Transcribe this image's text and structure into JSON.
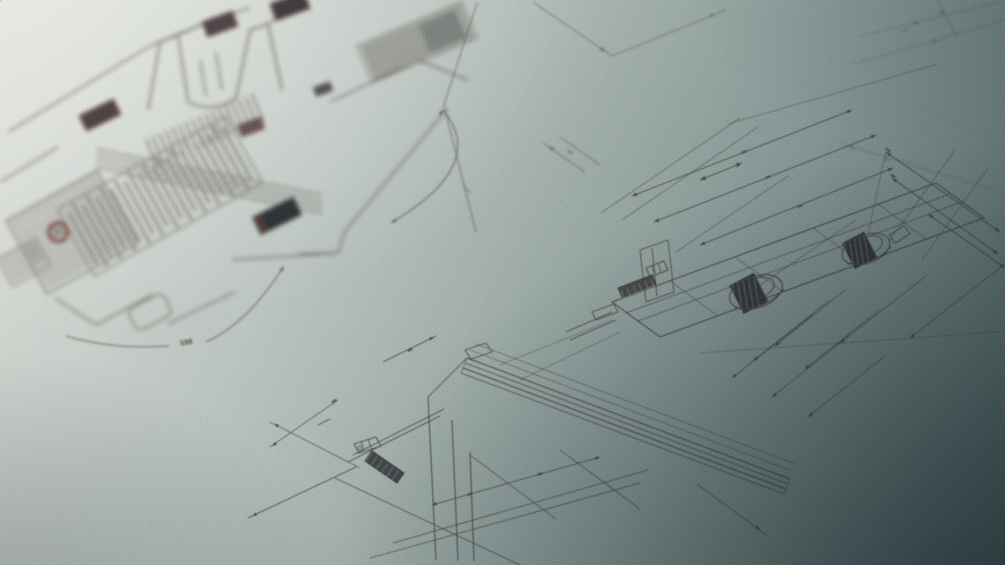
{
  "annotations": {
    "angle_label": "135"
  },
  "colors": {
    "paper_light": "#d6d9d3",
    "paper_mid": "#a9b5b1",
    "paper_dark": "#5f7173",
    "ink": "#4c4845",
    "ink_soft": "#6b635c",
    "ink_faint": "#7b746d",
    "ink_dark": "#24282b",
    "seal_dark": "#21272b",
    "seal_maroon": "#35262b",
    "maroon_accent": "#6e3c35",
    "hatch_light": "#98a099",
    "vignette": "#0e1c20"
  }
}
